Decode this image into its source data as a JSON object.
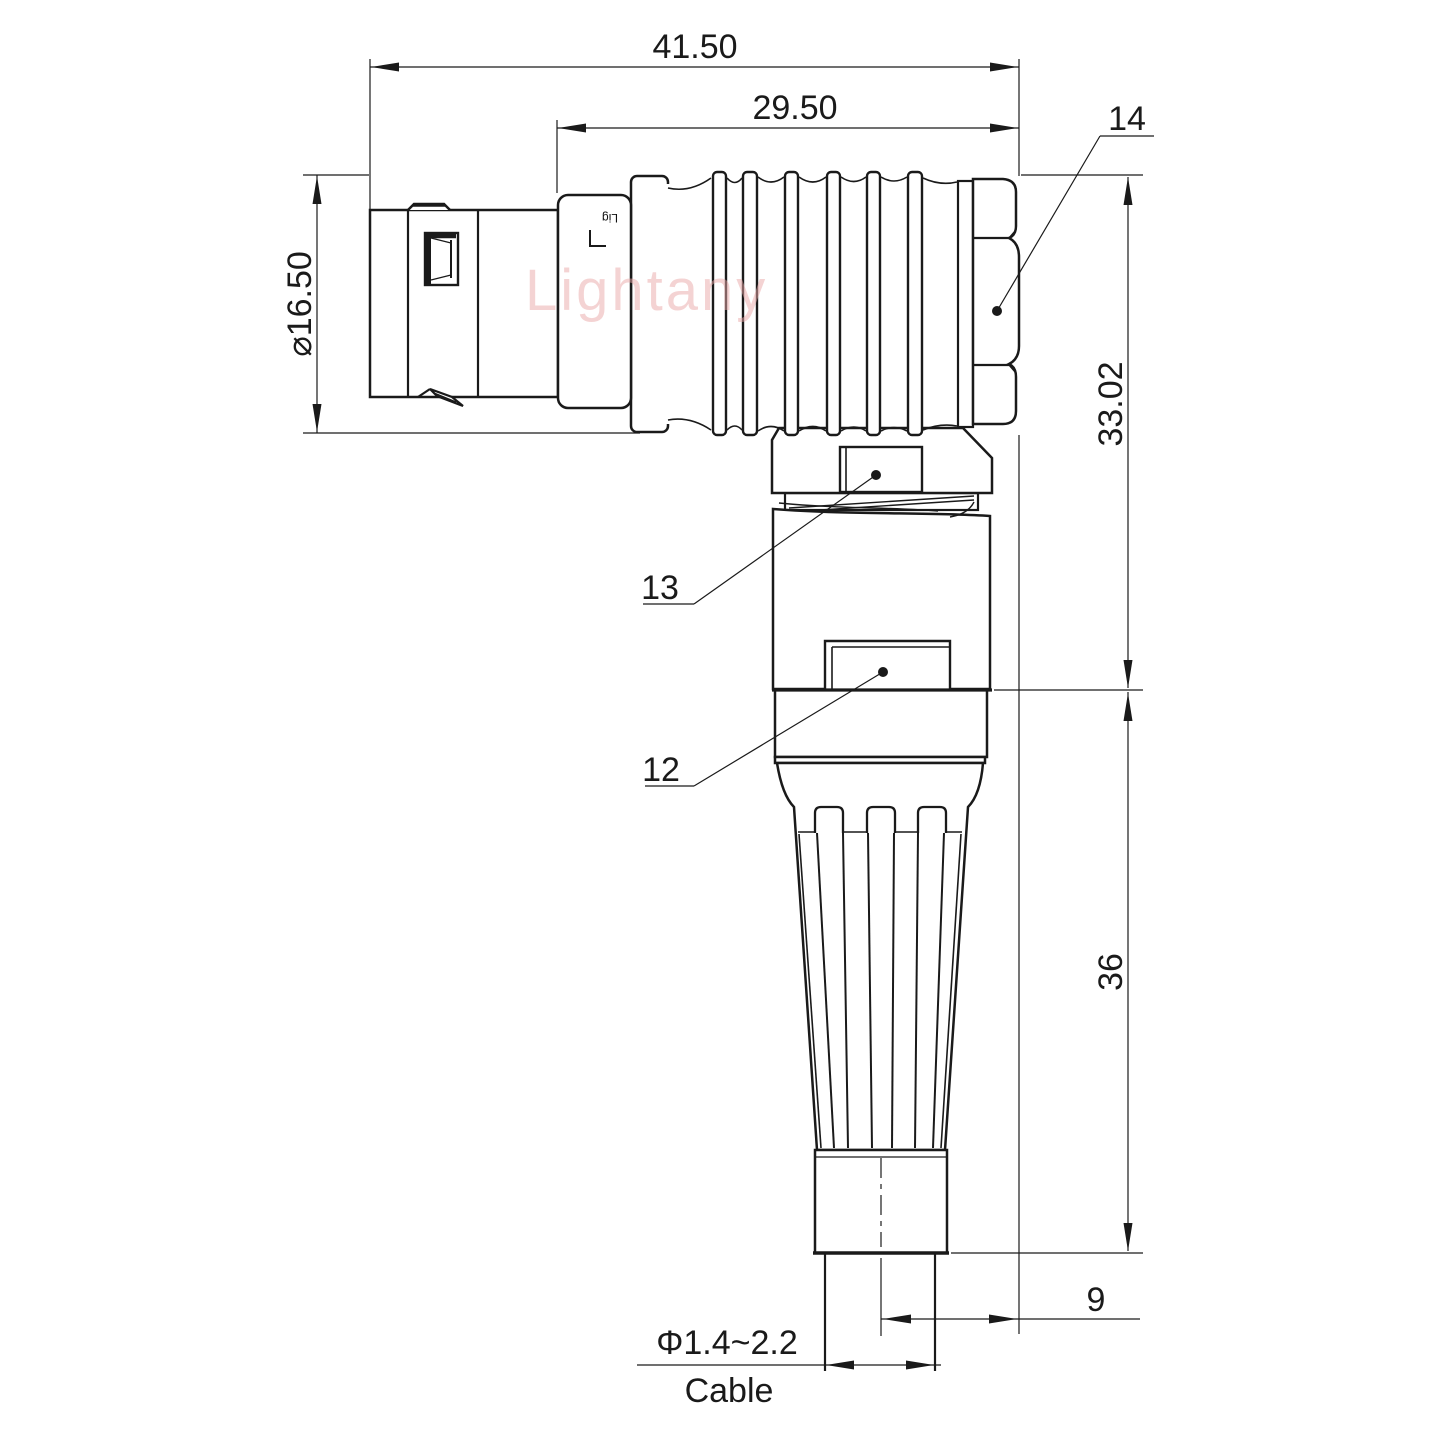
{
  "watermark": {
    "text": "Lightany"
  },
  "shell_marking": {
    "text": "Lig"
  },
  "dimensions": {
    "overall_length": "41.50",
    "rear_section_length": "29.50",
    "shell_diameter": "⌀16.50",
    "axis_to_top_height": "33.02",
    "boot_length": "36",
    "cable_axis_offset": "9",
    "cable_diameter_range": "Φ1.4~2.2",
    "cable_label": "Cable"
  },
  "callouts": {
    "backnut": "14",
    "upper_latch": "13",
    "lower_latch": "12"
  },
  "colors": {
    "line": "#1a1a1a",
    "watermark": "#eba9a9",
    "background": "#ffffff"
  }
}
